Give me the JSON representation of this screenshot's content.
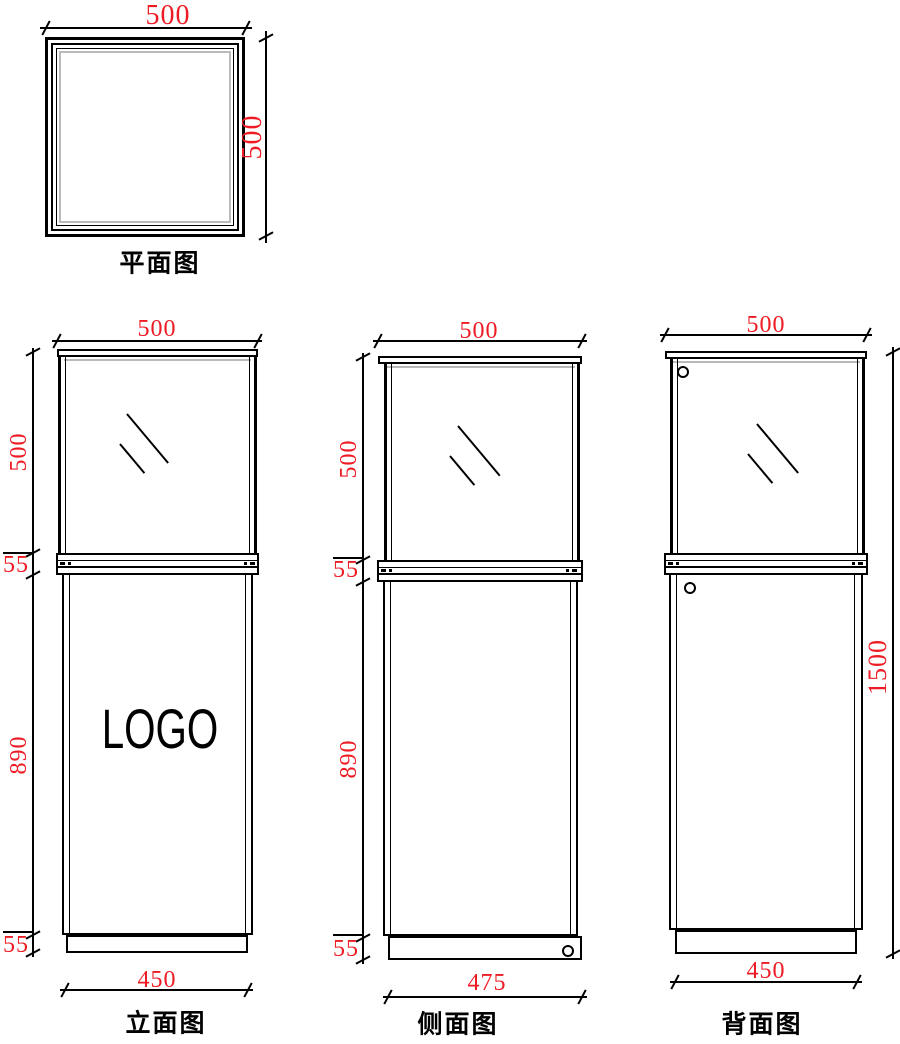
{
  "colors": {
    "dimension_red": "#ed1c24",
    "line_black": "#000000",
    "glass_gray": "#b9b9b9"
  },
  "views": {
    "plan": {
      "label": "平面图",
      "dims": {
        "width": "500",
        "depth": "500"
      }
    },
    "front": {
      "label": "立面图",
      "logo_text": "LOGO",
      "dims": {
        "top_width": "500",
        "glass_height": "500",
        "shelf_height": "55",
        "body_height": "890",
        "base_height": "55",
        "base_width": "450"
      }
    },
    "side": {
      "label": "侧面图",
      "dims": {
        "top_width": "500",
        "glass_height": "500",
        "shelf_height": "55",
        "body_height": "890",
        "base_height": "55",
        "base_width": "475"
      }
    },
    "back": {
      "label": "背面图",
      "dims": {
        "top_width": "500",
        "total_height": "1500",
        "base_width": "450"
      }
    }
  }
}
